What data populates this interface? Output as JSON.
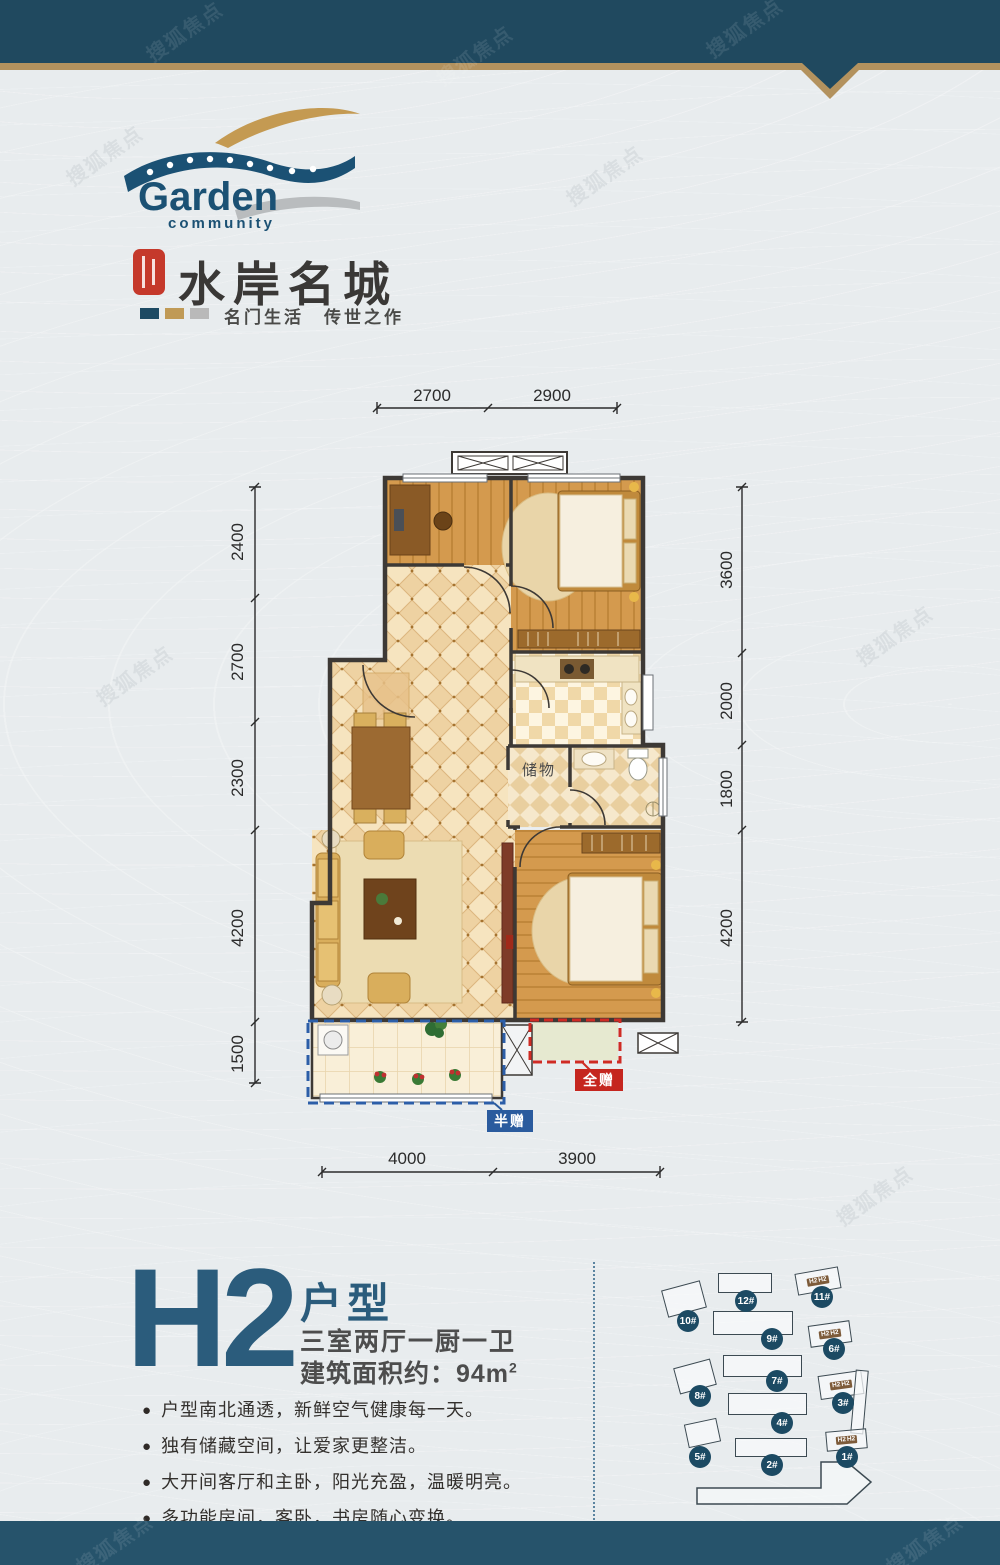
{
  "watermark": "搜狐焦点",
  "colors": {
    "banner": "#20495f",
    "gold": "#b3925e",
    "accent_blue": "#2b5c7c",
    "label_red": "#c5261f",
    "label_blue": "#2a5b9e",
    "badge": "#1c4a63"
  },
  "logo": {
    "name": "Garden",
    "sub": "community"
  },
  "brand": {
    "title": "水岸名城",
    "tagline": "名门生活　传世之作"
  },
  "plan": {
    "storage_label": "储物",
    "gift_full": "全赠",
    "gift_half": "半赠",
    "dims": {
      "top": [
        "2700",
        "2900"
      ],
      "left": [
        "2400",
        "2700",
        "2300",
        "4200",
        "1500"
      ],
      "right": [
        "3600",
        "2000",
        "1800",
        "4200"
      ],
      "bottom": [
        "4000",
        "3900"
      ]
    }
  },
  "info": {
    "code": "H2",
    "type_label": "户型",
    "rooms": "三室两厅一厨一卫",
    "area": "建筑面积约：94m",
    "area_sup": "2",
    "bullets": [
      "户型南北通透，新鲜空气健康每一天。",
      "独有储藏空间，让爱家更整洁。",
      "大开间客厅和主卧，阳光充盈，温暖明亮。",
      "多功能房间，客卧，书房随心变换。"
    ]
  },
  "siteplan": {
    "unit_tag": "H2",
    "buildings": [
      {
        "label": "1#",
        "h2": true
      },
      {
        "label": "2#",
        "h2": false
      },
      {
        "label": "3#",
        "h2": true
      },
      {
        "label": "4#",
        "h2": false
      },
      {
        "label": "5#",
        "h2": false
      },
      {
        "label": "6#",
        "h2": true
      },
      {
        "label": "7#",
        "h2": false
      },
      {
        "label": "8#",
        "h2": false
      },
      {
        "label": "9#",
        "h2": false
      },
      {
        "label": "10#",
        "h2": false
      },
      {
        "label": "11#",
        "h2": true
      },
      {
        "label": "12#",
        "h2": false
      }
    ]
  }
}
